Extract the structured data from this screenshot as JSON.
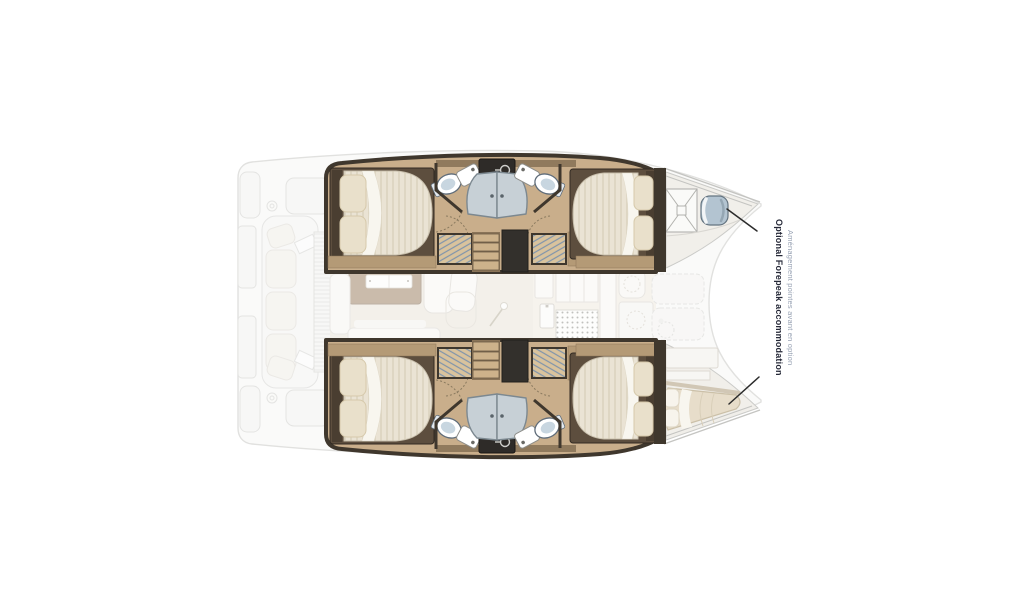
{
  "figure": {
    "type": "catamaran-deck-plan",
    "view": "top-down"
  },
  "annotation": {
    "title": "Optional Forepeak accommodation",
    "subtitle": "Aménagement pointes avant en option",
    "title_color": "#252837",
    "subtitle_color": "#97a1b3",
    "arrow_color": "#2b2b2b"
  },
  "palette": {
    "background": "#ffffff",
    "deck_faded_fill": "#f7f7f5",
    "deck_faded_stroke": "#c9c9c6",
    "hull_floor_wood": "#c9ae8b",
    "wall_dark": "#3f372d",
    "wood_trim": "#b49a76",
    "mattress": "#eae3d4",
    "pillow": "#e9e0cb",
    "duvet_white": "#f8f6ef",
    "shower_glass": "#c7d0d6",
    "appliance_dark": "#2e2b28",
    "wardrobe_hatch_lines": "#7f94ab",
    "forepeak_cushion": "#b0c2cf",
    "vberth_cushion": "#e6dcc8",
    "saloon_table": "#9f8568",
    "saloon_floor": "#ebe4d9"
  }
}
